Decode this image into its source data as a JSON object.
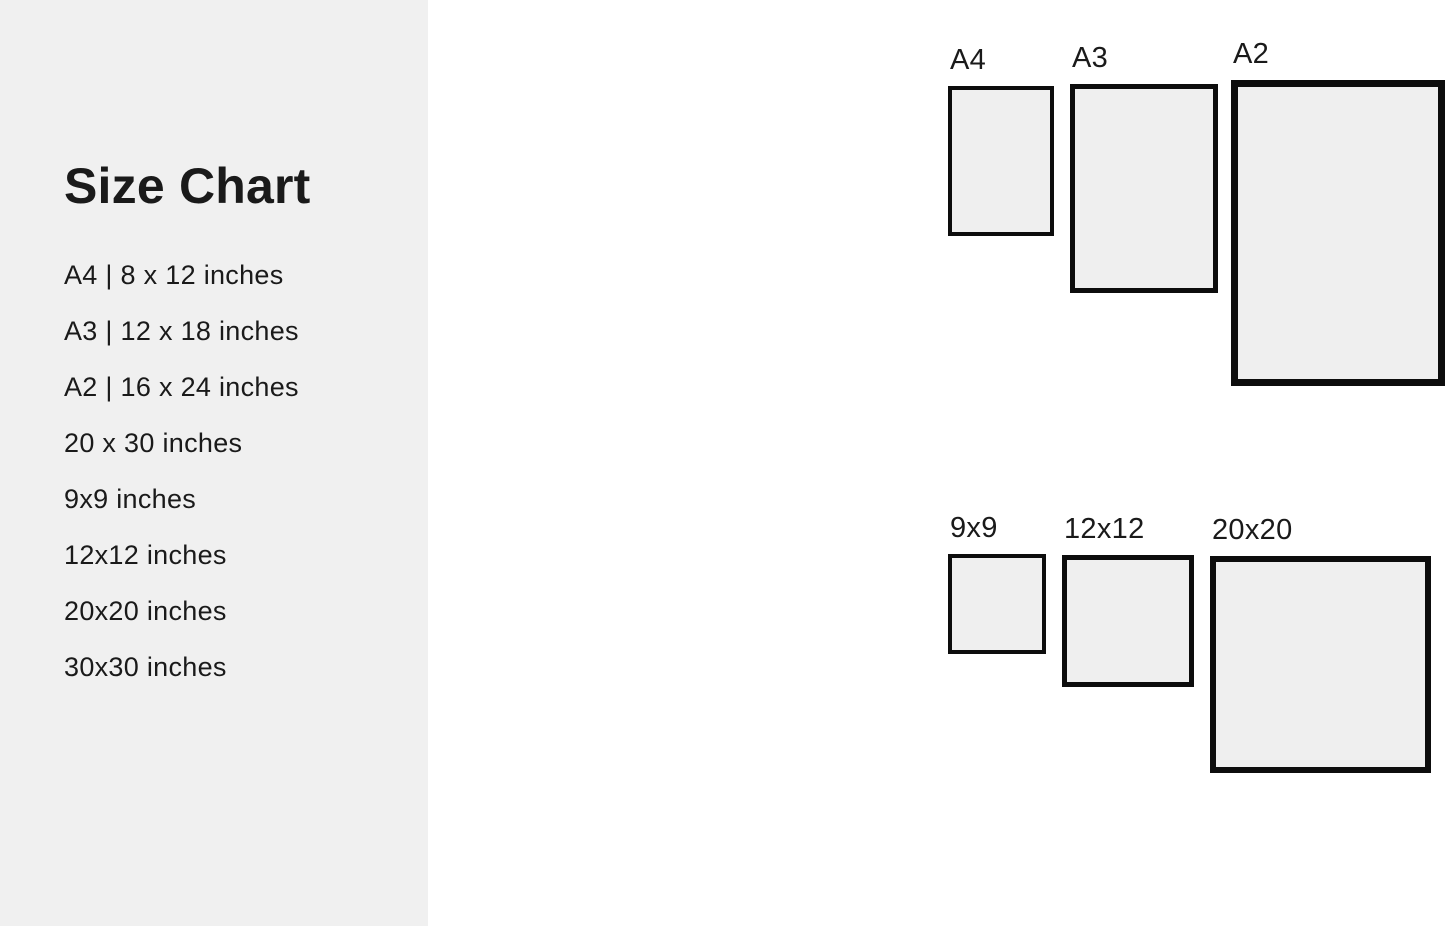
{
  "title": "Size Chart",
  "size_list": [
    "A4 | 8 x 12 inches",
    "A3 | 12 x 18 inches",
    "A2 | 16 x 24 inches",
    "20 x 30 inches",
    "9x9 inches",
    "12x12 inches",
    "20x20 inches",
    "30x30 inches"
  ],
  "frames": [
    {
      "label": "A4"
    },
    {
      "label": "A3"
    },
    {
      "label": "A2"
    },
    {
      "label": "20x30"
    },
    {
      "label": "9x9"
    },
    {
      "label": "12x12"
    },
    {
      "label": "20x20"
    },
    {
      "label": "30x30"
    }
  ],
  "colors": {
    "background": "#ffffff",
    "sidebar_bg": "#f0f0f0",
    "frame_fill": "#efefef",
    "frame_border": "#0d0d0d",
    "text": "#1a1a1a"
  }
}
